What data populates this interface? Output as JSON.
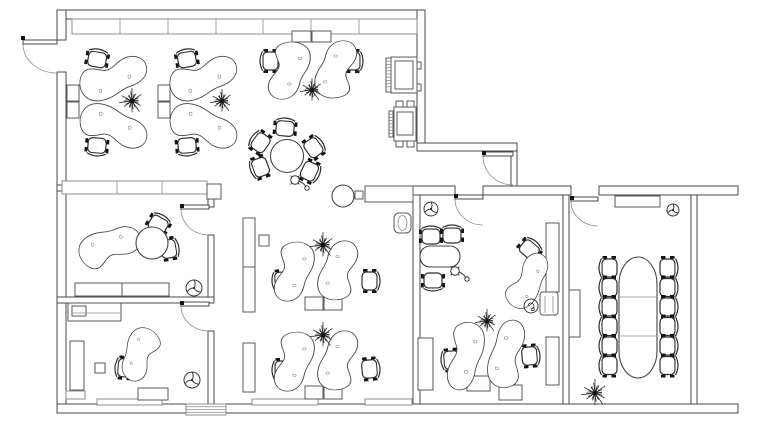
{
  "meta": {
    "label": "office-floor-plan-drawing",
    "canvas": {
      "w": 768,
      "h": 424
    },
    "ink": "#3a3a3a",
    "background": "#ffffff"
  },
  "floorplan": {
    "walls": [
      [
        57,
        10,
        368,
        9
      ],
      [
        57,
        10,
        9,
        30
      ],
      [
        57,
        72,
        9,
        341
      ],
      [
        57,
        404,
        681,
        9
      ],
      [
        417,
        10,
        8,
        136
      ],
      [
        417,
        143,
        100,
        8
      ],
      [
        511,
        151,
        6,
        36
      ],
      [
        413,
        186,
        42,
        9
      ],
      [
        483,
        186,
        88,
        9
      ],
      [
        599,
        186,
        139,
        9
      ],
      [
        413,
        195,
        7,
        209
      ],
      [
        563,
        195,
        6,
        209
      ],
      [
        691,
        195,
        6,
        209
      ],
      [
        57,
        185,
        157,
        6
      ],
      [
        208,
        185,
        6,
        22
      ],
      [
        208,
        235,
        6,
        68
      ],
      [
        208,
        331,
        6,
        73
      ],
      [
        57,
        297,
        157,
        6
      ]
    ],
    "doors": [
      {
        "leaf": [
          23,
          40,
          34,
          4
        ],
        "arc": "M23,44 A34,29 0 0 0 57,73",
        "dot": [
          21,
          36
        ]
      },
      {
        "leaf": [
          181,
          205,
          28,
          4
        ],
        "arc": "M181,209 A28,26 0 0 0 209,235",
        "dot": [
          180,
          204
        ]
      },
      {
        "leaf": [
          181,
          302,
          28,
          4
        ],
        "arc": "M181,306 A28,25 0 0 0 209,331",
        "dot": [
          180,
          301
        ]
      },
      {
        "leaf": [
          483,
          152,
          30,
          4
        ],
        "arc": "M483,156 A30,29 0 0 0 513,185",
        "dot": [
          482,
          151
        ]
      },
      {
        "leaf": [
          455,
          195,
          28,
          4
        ],
        "arc": "M455,199 A28,26 0 0 0 483,225",
        "dot": [
          454,
          194
        ]
      },
      {
        "leaf": [
          571,
          197,
          27,
          4
        ],
        "arc": "M571,201 A27,25 0 0 0 598,226",
        "dot": [
          570,
          196
        ]
      }
    ],
    "cabinet_rows": [
      {
        "x": 72,
        "y": 19,
        "w": 345,
        "h": 15,
        "dividers": [
          120,
          168,
          216,
          263,
          311,
          359
        ]
      },
      {
        "x": 62,
        "y": 181,
        "w": 145,
        "h": 13,
        "dividers": [
          117,
          162
        ]
      }
    ],
    "radiators": [
      [
        97,
        399,
        65,
        6
      ],
      [
        252,
        399,
        66,
        6
      ],
      [
        365,
        399,
        47,
        6
      ],
      [
        66,
        391,
        19,
        8
      ]
    ],
    "entrance": {
      "x": 186,
      "y": 404,
      "w": 40,
      "h": 11,
      "lines": 3
    },
    "pedestals": [
      [
        67,
        85,
        12,
        16
      ],
      [
        67,
        102,
        12,
        16
      ],
      [
        158,
        85,
        12,
        16
      ],
      [
        158,
        102,
        12,
        16
      ],
      [
        292,
        31,
        19,
        11
      ],
      [
        312,
        31,
        19,
        11
      ],
      [
        305,
        297,
        18,
        13
      ],
      [
        324,
        297,
        18,
        13
      ],
      [
        305,
        386,
        18,
        13
      ],
      [
        324,
        386,
        18,
        13
      ],
      [
        467,
        376,
        23,
        15
      ],
      [
        499,
        385,
        23,
        15
      ],
      [
        138,
        388,
        30,
        12
      ]
    ],
    "sideboards": [
      [
        243,
        218,
        12,
        49
      ],
      [
        243,
        267,
        12,
        45
      ],
      [
        243,
        343,
        12,
        49
      ],
      [
        418,
        338,
        15,
        52
      ],
      [
        546,
        223,
        13,
        69
      ],
      [
        546,
        337,
        13,
        48
      ],
      [
        569,
        290,
        11,
        47
      ],
      [
        615,
        196,
        45,
        11
      ],
      [
        365,
        186,
        48,
        16
      ],
      [
        75,
        283,
        47,
        13
      ],
      [
        122,
        283,
        47,
        13
      ],
      [
        70,
        341,
        14,
        49
      ],
      [
        68,
        303,
        53,
        18
      ]
    ],
    "small_items": [
      [
        355,
        191,
        8,
        8
      ],
      [
        95,
        363,
        10,
        10
      ],
      [
        259,
        235,
        10,
        11
      ],
      [
        207,
        184,
        14,
        15
      ],
      [
        72,
        306,
        14,
        10
      ]
    ],
    "machines": [
      {
        "outer": [
          391,
          57,
          26,
          36
        ],
        "inner": [
          395,
          61,
          18,
          28
        ],
        "hatch": [
          386,
          58,
          5,
          34
        ],
        "tabs": [
          [
            417,
            62,
            4,
            7
          ],
          [
            417,
            84,
            4,
            7
          ]
        ]
      },
      {
        "outer": [
          394,
          107,
          22,
          34
        ],
        "inner": [
          397,
          112,
          16,
          23
        ],
        "hatch": [
          389,
          111,
          4,
          26
        ],
        "tabs": [
          [
            396,
            101,
            7,
            6
          ],
          [
            407,
            101,
            7,
            6
          ],
          [
            396,
            141,
            7,
            6
          ],
          [
            407,
            141,
            7,
            6
          ]
        ]
      }
    ],
    "cabinet_unit": {
      "x": 540,
      "y": 292,
      "w": 18,
      "h": 23,
      "rx": 3,
      "lines": [
        [
          545,
          296,
          545,
          313
        ],
        [
          553,
          296,
          553,
          313
        ]
      ]
    },
    "waste_bin": {
      "x": 394,
      "y": 213,
      "w": 17,
      "h": 20,
      "rx": 5,
      "ellipse": [
        402.5,
        223,
        4.5,
        7.5
      ]
    },
    "misc_lines": [
      [
        72,
        313,
        120,
        313
      ]
    ],
    "desks": [
      {
        "shape": "du",
        "t": "rotate(-8 112 79) translate(77 57) scale(0.73 0.82)"
      },
      {
        "shape": "dd",
        "t": "rotate(8 112 127) translate(77 104) scale(0.73 0.82)"
      },
      {
        "shape": "du",
        "t": "rotate(-8 202 79) translate(167 57) scale(0.73 0.82)"
      },
      {
        "shape": "dd",
        "t": "rotate(8 202 127) translate(167 104) scale(0.73 0.82)"
      },
      {
        "shape": "dd",
        "t": "translate(312 40) rotate(90) scale(0.61 0.87)"
      },
      {
        "shape": "dd",
        "t": "translate(313 100) rotate(-90) scale(0.61 0.87)"
      },
      {
        "shape": "dd",
        "t": "translate(316 240) rotate(90) scale(0.63 0.83)"
      },
      {
        "shape": "dd",
        "t": "translate(316 302) rotate(-90) scale(0.63 0.83)"
      },
      {
        "shape": "dd",
        "t": "translate(316 330) rotate(90) scale(0.63 0.83)"
      },
      {
        "shape": "dd",
        "t": "translate(316 392) rotate(-90) scale(0.63 0.83)"
      },
      {
        "shape": "dd",
        "t": "translate(486 320) rotate(90) scale(0.72 0.77)"
      },
      {
        "shape": "dd",
        "t": "translate(486 390) rotate(-90) scale(0.72 0.77)"
      },
      {
        "shape": "dd",
        "t": "translate(70 247) rotate(-35) scale(0.66 0.8)"
      },
      {
        "shape": "du",
        "t": "translate(172 344) rotate(128) scale(0.56 0.75)"
      },
      {
        "shape": "du",
        "t": "translate(494 292) rotate(-48) scale(0.62 0.7)"
      }
    ],
    "chairs": [
      [
        97,
        60,
        10
      ],
      [
        97,
        145,
        185
      ],
      [
        187,
        60,
        -10
      ],
      [
        187,
        145,
        175
      ],
      [
        271,
        61,
        -90
      ],
      [
        352,
        61,
        90
      ],
      [
        285,
        129,
        5
      ],
      [
        261,
        143,
        -55
      ],
      [
        261,
        167,
        -110
      ],
      [
        313,
        148,
        55
      ],
      [
        309,
        171,
        115
      ],
      [
        99,
        250,
        140
      ],
      [
        158,
        225,
        30
      ],
      [
        168,
        249,
        80
      ],
      [
        126,
        368,
        -85
      ],
      [
        283,
        281,
        -95
      ],
      [
        369,
        281,
        90
      ],
      [
        283,
        370,
        -90
      ],
      [
        369,
        369,
        85
      ],
      [
        431,
        237,
        0
      ],
      [
        452,
        236,
        0
      ],
      [
        433,
        280,
        180
      ],
      [
        452,
        360,
        -95
      ],
      [
        529,
        356,
        85
      ],
      [
        529,
        250,
        40
      ],
      [
        610,
        268,
        -90
      ],
      [
        610,
        287.5,
        -90
      ],
      [
        610,
        307,
        -90
      ],
      [
        610,
        326.5,
        -90
      ],
      [
        610,
        346,
        -90
      ],
      [
        610,
        365.5,
        -90
      ],
      [
        667,
        268,
        90
      ],
      [
        667,
        287.5,
        90
      ],
      [
        667,
        307,
        90
      ],
      [
        667,
        326.5,
        90
      ],
      [
        667,
        346,
        90
      ],
      [
        667,
        365.5,
        90
      ]
    ],
    "round_tables": [
      {
        "cx": 287,
        "cy": 156,
        "r": 16.5
      },
      {
        "cx": 152,
        "cy": 243,
        "r": 16
      },
      {
        "cx": 343,
        "cy": 196,
        "r": 11
      }
    ],
    "office_table": {
      "x": 420,
      "y": 246,
      "w": 40,
      "h": 21,
      "rx": 10
    },
    "conference_table": {
      "x": 619,
      "y": 257,
      "w": 38,
      "h": 121,
      "rx": 19,
      "ry": 27,
      "dividers": [
        297,
        336
      ]
    },
    "plants": [
      [
        132,
        101,
        13
      ],
      [
        222,
        101,
        12
      ],
      [
        312,
        90,
        12
      ],
      [
        323,
        245,
        13
      ],
      [
        323,
        335,
        13
      ],
      [
        487,
        321,
        12
      ],
      [
        595,
        393,
        14
      ]
    ],
    "pot_plant": {
      "cx": 531,
      "cy": 306,
      "r": 7
    },
    "fans": [
      [
        194,
        288,
        8
      ],
      [
        192,
        380,
        8
      ],
      [
        431,
        209,
        7
      ],
      [
        673,
        210,
        6
      ]
    ],
    "lamps": [
      [
        295,
        180
      ],
      [
        455,
        271
      ]
    ]
  }
}
